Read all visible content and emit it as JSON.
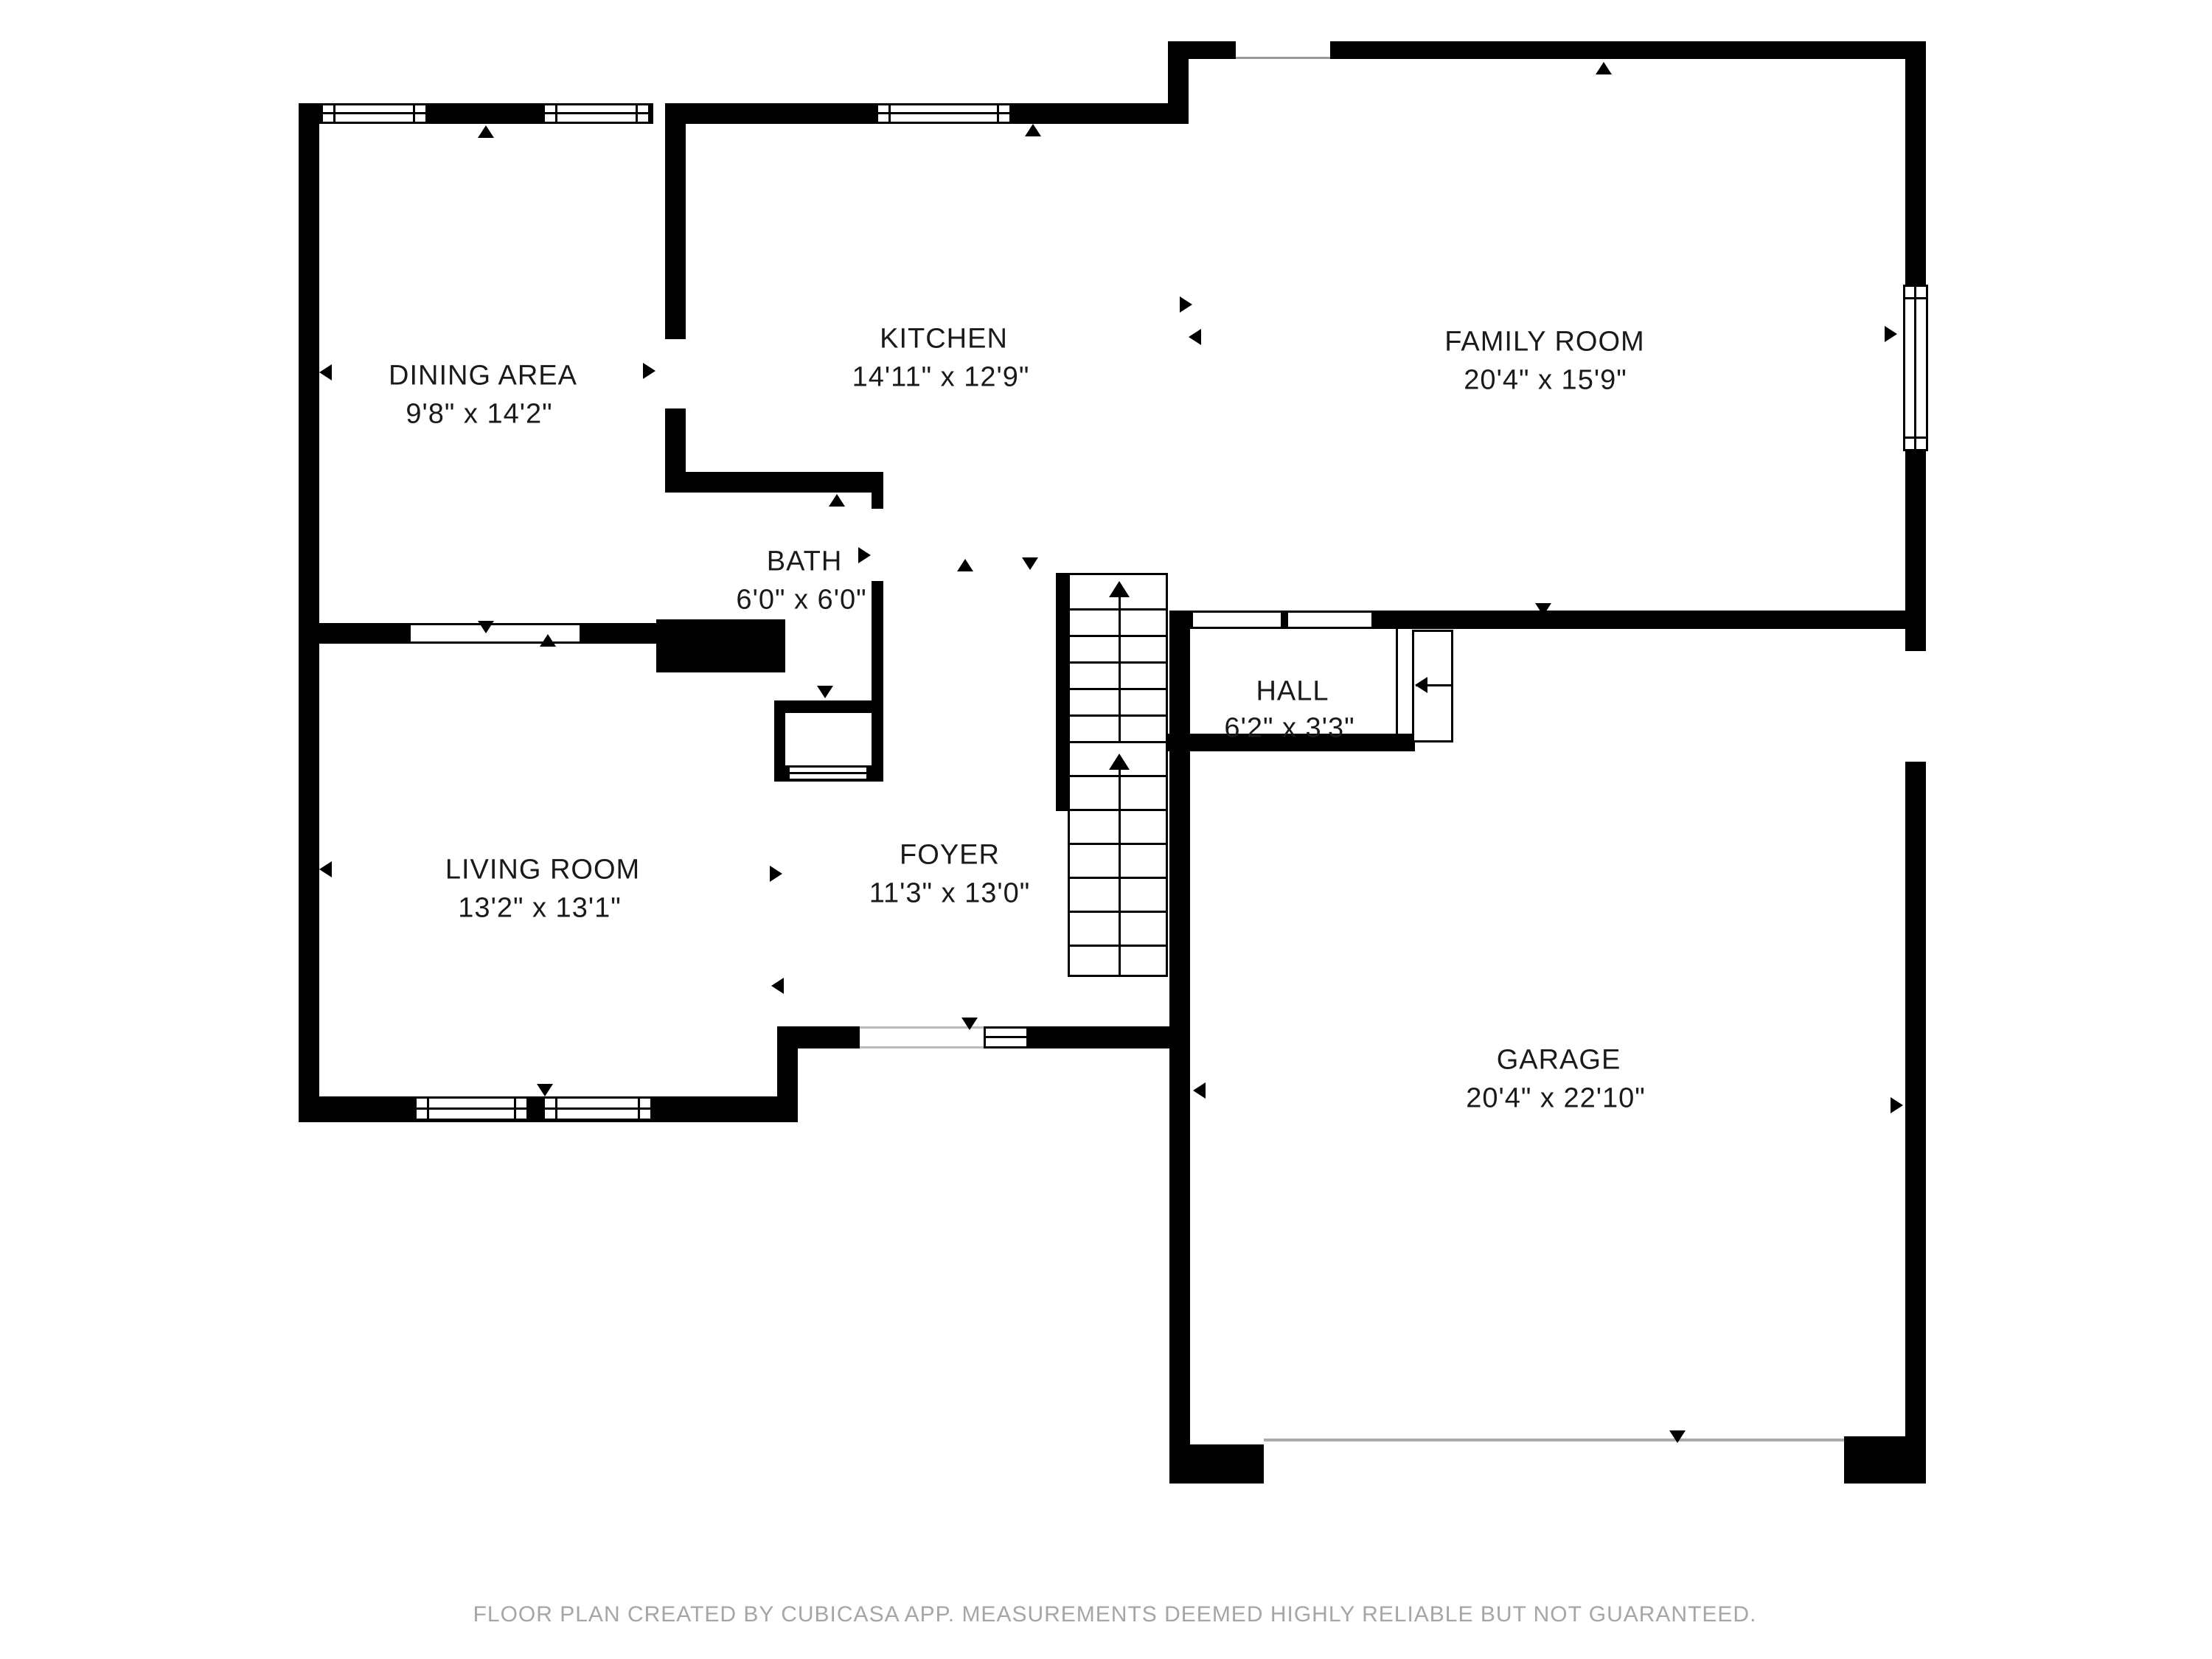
{
  "rooms": [
    {
      "id": "dining",
      "name": "DINING AREA",
      "dims": "9'8\" x 14'2\""
    },
    {
      "id": "kitchen",
      "name": "KITCHEN",
      "dims": "14'11\" x 12'9\""
    },
    {
      "id": "family",
      "name": "FAMILY ROOM",
      "dims": "20'4\" x 15'9\""
    },
    {
      "id": "bath",
      "name": "BATH",
      "dims": "6'0\" x 6'0\""
    },
    {
      "id": "hall",
      "name": "HALL",
      "dims": "6'2\" x 3'3\""
    },
    {
      "id": "living",
      "name": "LIVING ROOM",
      "dims": "13'2\" x 13'1\""
    },
    {
      "id": "foyer",
      "name": "FOYER",
      "dims": "11'3\" x 13'0\""
    },
    {
      "id": "garage",
      "name": "GARAGE",
      "dims": "20'4\" x 22'10\""
    }
  ],
  "footer": {
    "disclaimer": "FLOOR PLAN CREATED BY CUBICASA APP. MEASUREMENTS DEEMED HIGHLY RELIABLE BUT NOT GUARANTEED."
  },
  "colors": {
    "wall": "#000000",
    "background": "#ffffff",
    "footer_text": "#a6a6a6",
    "opening_line": "#bbbbbb"
  }
}
